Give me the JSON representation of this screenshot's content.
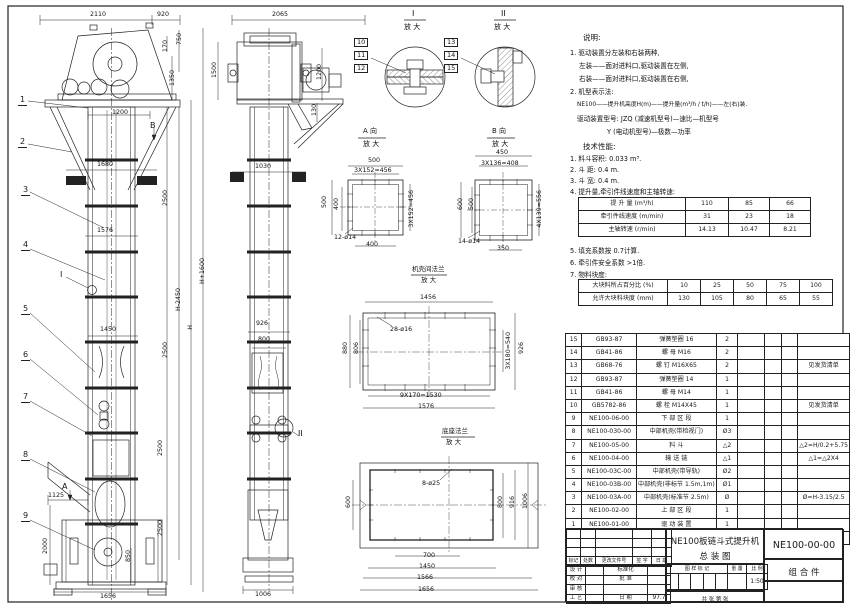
{
  "colors": {
    "line": "#222222",
    "paper": "#ffffff"
  },
  "detail_titles": {
    "i": "I",
    "ii": "II",
    "a": "A 向",
    "b": "B 向",
    "flange": "机壳间法兰",
    "base": "底座法兰",
    "enlarge": "放 大"
  },
  "right_texts": [
    {
      "t": "说明:",
      "x": 583,
      "y": 34,
      "fs": 7.5
    },
    {
      "t": "1. 驱动装置分左装和右装两种,",
      "x": 570,
      "y": 50
    },
    {
      "t": "左装——面对进料口,驱动装置在左侧,",
      "x": 579,
      "y": 63
    },
    {
      "t": "右装——面对进料口,驱动装置在右侧,",
      "x": 579,
      "y": 76
    },
    {
      "t": "2. 机型表示法:",
      "x": 570,
      "y": 89
    },
    {
      "t": "NE100——提升机高度H(m)——提升量(m³/h / t/h)——左(右)装.",
      "x": 577,
      "y": 103,
      "fs": 5.8
    },
    {
      "t": "驱动装置型号: JZQ (减速机型号)—速比—机型号",
      "x": 577,
      "y": 116
    },
    {
      "t": "Y (电动机型号)—极数—功率",
      "x": 607,
      "y": 129
    },
    {
      "t": "技术性能:",
      "x": 583,
      "y": 143,
      "fs": 7.5
    },
    {
      "t": "1. 料斗容积: 0.033 m³.",
      "x": 570,
      "y": 156
    },
    {
      "t": "2. 斗  距: 0.4 m.",
      "x": 570,
      "y": 167
    },
    {
      "t": "3. 斗  宽: 0.4 m.",
      "x": 570,
      "y": 178
    },
    {
      "t": "4. 提升量,牵引件线速度和主轴转速:",
      "x": 570,
      "y": 189
    },
    {
      "t": "5. 填充系数按 0.7计算.",
      "x": 570,
      "y": 248
    },
    {
      "t": "6. 牵引件安全系数 >1倍.",
      "x": 570,
      "y": 260
    },
    {
      "t": "7. 物料块度:",
      "x": 570,
      "y": 272
    }
  ],
  "perf_table": {
    "x": 578,
    "y": 197,
    "cols": [
      104,
      40,
      38,
      38
    ],
    "rows": [
      [
        "提 升 量  (m³/h)",
        "110",
        "85",
        "66"
      ],
      [
        "牵引件线速度 (m/min)",
        "31",
        "23",
        "18"
      ],
      [
        "主轴转速  (r/min)",
        "14.13",
        "10.47",
        "8.21"
      ]
    ]
  },
  "lump_table": {
    "x": 578,
    "y": 279,
    "cols": [
      86,
      30,
      30,
      30,
      30,
      30
    ],
    "rows": [
      [
        "大块料所占百分比 (%)",
        "10",
        "25",
        "50",
        "75",
        "100"
      ],
      [
        "允许大块料块度 (mm)",
        "130",
        "105",
        "80",
        "65",
        "55"
      ]
    ]
  },
  "bom": {
    "x": 565,
    "y": 333,
    "cols": [
      14,
      62,
      70,
      24,
      36,
      15,
      15,
      42
    ],
    "row_h": 12.19,
    "header": [
      "序号",
      "代  号",
      "名        称",
      "数 量",
      "材    料",
      "单重",
      "总重",
      "备  注"
    ],
    "rows": [
      [
        "15",
        "GB93-87",
        "弹簧垫圈  16",
        "2",
        "",
        "",
        "",
        ""
      ],
      [
        "14",
        "GB41-86",
        "螺 母  M16",
        "2",
        "",
        "",
        "",
        ""
      ],
      [
        "13",
        "GB68-76",
        "螺 钉  M16X65",
        "2",
        "",
        "",
        "",
        "见发货清单"
      ],
      [
        "12",
        "GB93-87",
        "弹簧垫圈  14",
        "1",
        "",
        "",
        "",
        ""
      ],
      [
        "11",
        "GB41-86",
        "螺 母  M14",
        "1",
        "",
        "",
        "",
        ""
      ],
      [
        "10",
        "GB5782-86",
        "螺 栓  M14X45",
        "1",
        "",
        "",
        "",
        "见发货清单"
      ],
      [
        "9",
        "NE100-06-00",
        "下 部 区 段",
        "1",
        "",
        "",
        "",
        ""
      ],
      [
        "8",
        "NE100-030-00",
        "中部机壳(带检视门)",
        "Ø3",
        "",
        "",
        "",
        ""
      ],
      [
        "7",
        "NE100-05-00",
        "料  斗",
        "△2",
        "",
        "",
        "",
        "△2=H/0.2+5.75"
      ],
      [
        "6",
        "NE100-04-00",
        "输 送 链",
        "△1",
        "",
        "",
        "",
        "△1=△2X4"
      ],
      [
        "5",
        "NE100-03C-00",
        "中部机壳(带导轨)",
        "Ø2",
        "",
        "",
        "",
        ""
      ],
      [
        "4",
        "NE100-03B-00",
        "中部机壳(非标节 1.5m,1m)",
        "Ø1",
        "",
        "",
        "",
        ""
      ],
      [
        "3",
        "NE100-03A-00",
        "中部机壳(标准节 2.5m)",
        "Ø",
        "",
        "",
        "",
        "Ø=H-3.15/2.5"
      ],
      [
        "2",
        "NE100-02-00",
        "上 部 区 段",
        "1",
        "",
        "",
        "",
        ""
      ],
      [
        "1",
        "NE100-01-00",
        "驱 动 装 置",
        "1",
        "",
        "",
        "",
        ""
      ]
    ]
  },
  "title_block": {
    "name1": "NE100板链斗式提升机",
    "name2": "总  装  图",
    "drawing_no": "NE100-00-00",
    "part_type": "组 合 件",
    "rev_cols": [
      "标记",
      "处数",
      "更改文件号",
      "签 字",
      "日 期"
    ],
    "roles": [
      "设 计",
      "校 对",
      "审 核",
      "工 艺"
    ],
    "col2": [
      "标准化",
      "批 准",
      "",
      "日 期"
    ],
    "date_value": "97.7",
    "mark_label": "图 样 标 记",
    "weight_label": "重 量",
    "scale_label": "比 例",
    "scale_value": "1:50",
    "sheet_label": "共    张    第    张"
  },
  "balloons": [
    {
      "n": "1",
      "x": 18,
      "y": 96
    },
    {
      "n": "2",
      "x": 18,
      "y": 138
    },
    {
      "n": "3",
      "x": 21,
      "y": 186
    },
    {
      "n": "4",
      "x": 21,
      "y": 241
    },
    {
      "n": "5",
      "x": 21,
      "y": 305
    },
    {
      "n": "6",
      "x": 21,
      "y": 351
    },
    {
      "n": "7",
      "x": 21,
      "y": 393
    },
    {
      "n": "8",
      "x": 21,
      "y": 451
    },
    {
      "n": "9",
      "x": 21,
      "y": 512
    }
  ],
  "labels": [
    {
      "t": "2110",
      "x": 90,
      "y": 12
    },
    {
      "t": "920",
      "x": 157,
      "y": 12
    },
    {
      "t": "170",
      "x": 163,
      "y": 40,
      "r": 1
    },
    {
      "t": "750",
      "x": 177,
      "y": 33,
      "r": 1
    },
    {
      "t": "1350",
      "x": 170,
      "y": 70,
      "r": 1
    },
    {
      "t": "1500",
      "x": 212,
      "y": 62,
      "r": 1
    },
    {
      "t": "1200",
      "x": 112,
      "y": 110
    },
    {
      "t": "B",
      "x": 150,
      "y": 122,
      "fs": 8
    },
    {
      "t": "1680",
      "x": 97,
      "y": 162
    },
    {
      "t": "2500",
      "x": 163,
      "y": 190,
      "r": 1
    },
    {
      "t": "1576",
      "x": 97,
      "y": 228
    },
    {
      "t": "H-2450",
      "x": 176,
      "y": 288,
      "r": 1
    },
    {
      "t": "H",
      "x": 188,
      "y": 325,
      "r": 1
    },
    {
      "t": "H+1600",
      "x": 200,
      "y": 258,
      "r": 1
    },
    {
      "t": "1450",
      "x": 100,
      "y": 327
    },
    {
      "t": "2500",
      "x": 163,
      "y": 342,
      "r": 1
    },
    {
      "t": "2500",
      "x": 158,
      "y": 440,
      "r": 1
    },
    {
      "t": "2500",
      "x": 158,
      "y": 520,
      "r": 1
    },
    {
      "t": "850",
      "x": 126,
      "y": 550,
      "r": 1
    },
    {
      "t": "1125",
      "x": 48,
      "y": 493
    },
    {
      "t": "2000",
      "x": 43,
      "y": 538,
      "r": 1
    },
    {
      "t": "1656",
      "x": 100,
      "y": 594
    },
    {
      "t": "A",
      "x": 62,
      "y": 483,
      "fs": 8
    },
    {
      "t": "I",
      "x": 60,
      "y": 271,
      "fs": 8
    },
    {
      "t": "2065",
      "x": 272,
      "y": 12
    },
    {
      "t": "1200",
      "x": 317,
      "y": 64,
      "r": 1
    },
    {
      "t": "130",
      "x": 312,
      "y": 104,
      "r": 1
    },
    {
      "t": "1030",
      "x": 255,
      "y": 164
    },
    {
      "t": "926",
      "x": 256,
      "y": 321
    },
    {
      "t": "800",
      "x": 258,
      "y": 337
    },
    {
      "t": "1006",
      "x": 255,
      "y": 592
    },
    {
      "t": "II",
      "x": 298,
      "y": 430,
      "fs": 8
    },
    {
      "t": "I",
      "x": 412,
      "y": 10,
      "fs": 8
    },
    {
      "t": "放 大",
      "x": 404,
      "y": 24,
      "fs": 7
    },
    {
      "t": "II",
      "x": 501,
      "y": 10,
      "fs": 8
    },
    {
      "t": "放 大",
      "x": 494,
      "y": 24,
      "fs": 7
    },
    {
      "t": "10",
      "x": 354,
      "y": 38,
      "b": 1
    },
    {
      "t": "11",
      "x": 354,
      "y": 51,
      "b": 1
    },
    {
      "t": "12",
      "x": 354,
      "y": 64,
      "b": 1
    },
    {
      "t": "13",
      "x": 444,
      "y": 38,
      "b": 1
    },
    {
      "t": "14",
      "x": 444,
      "y": 51,
      "b": 1
    },
    {
      "t": "15",
      "x": 444,
      "y": 64,
      "b": 1
    },
    {
      "t": "A 向",
      "x": 363,
      "y": 128,
      "fs": 7
    },
    {
      "t": "放 大",
      "x": 363,
      "y": 141,
      "fs": 7
    },
    {
      "t": "500",
      "x": 368,
      "y": 158
    },
    {
      "t": "3X152=456",
      "x": 354,
      "y": 168
    },
    {
      "t": "500",
      "x": 322,
      "y": 196,
      "r": 1
    },
    {
      "t": "400",
      "x": 334,
      "y": 198,
      "r": 1
    },
    {
      "t": "3X152=456",
      "x": 409,
      "y": 190,
      "r": 1
    },
    {
      "t": "12-ø14",
      "x": 334,
      "y": 235
    },
    {
      "t": "400",
      "x": 366,
      "y": 242
    },
    {
      "t": "B 向",
      "x": 492,
      "y": 128,
      "fs": 7
    },
    {
      "t": "放 大",
      "x": 492,
      "y": 141,
      "fs": 7
    },
    {
      "t": "450",
      "x": 496,
      "y": 150
    },
    {
      "t": "3X136=408",
      "x": 481,
      "y": 161
    },
    {
      "t": "600",
      "x": 458,
      "y": 198,
      "r": 1
    },
    {
      "t": "500",
      "x": 469,
      "y": 198,
      "r": 1
    },
    {
      "t": "4X139=556",
      "x": 537,
      "y": 190,
      "r": 1
    },
    {
      "t": "14-ø14",
      "x": 458,
      "y": 239
    },
    {
      "t": "350",
      "x": 497,
      "y": 246
    },
    {
      "t": "机壳间法兰",
      "x": 412,
      "y": 266,
      "fs": 6.5
    },
    {
      "t": "放 大",
      "x": 421,
      "y": 277,
      "fs": 6.5
    },
    {
      "t": "1456",
      "x": 420,
      "y": 295
    },
    {
      "t": "28-ø16",
      "x": 390,
      "y": 327
    },
    {
      "t": "880",
      "x": 343,
      "y": 342,
      "r": 1
    },
    {
      "t": "806",
      "x": 354,
      "y": 342,
      "r": 1
    },
    {
      "t": "3X180=540",
      "x": 506,
      "y": 332,
      "r": 1
    },
    {
      "t": "926",
      "x": 519,
      "y": 342,
      "r": 1
    },
    {
      "t": "9X170=1530",
      "x": 400,
      "y": 393
    },
    {
      "t": "1576",
      "x": 418,
      "y": 404
    },
    {
      "t": "底座法兰",
      "x": 442,
      "y": 428,
      "fs": 6.5
    },
    {
      "t": "放 大",
      "x": 446,
      "y": 439,
      "fs": 6.5
    },
    {
      "t": "8-ø25",
      "x": 422,
      "y": 481
    },
    {
      "t": "600",
      "x": 346,
      "y": 496,
      "r": 1
    },
    {
      "t": "800",
      "x": 498,
      "y": 496,
      "r": 1
    },
    {
      "t": "916",
      "x": 510,
      "y": 496,
      "r": 1
    },
    {
      "t": "1006",
      "x": 523,
      "y": 493,
      "r": 1
    },
    {
      "t": "700",
      "x": 423,
      "y": 553
    },
    {
      "t": "1450",
      "x": 419,
      "y": 564
    },
    {
      "t": "1566",
      "x": 417,
      "y": 575
    },
    {
      "t": "1656",
      "x": 418,
      "y": 587
    }
  ]
}
